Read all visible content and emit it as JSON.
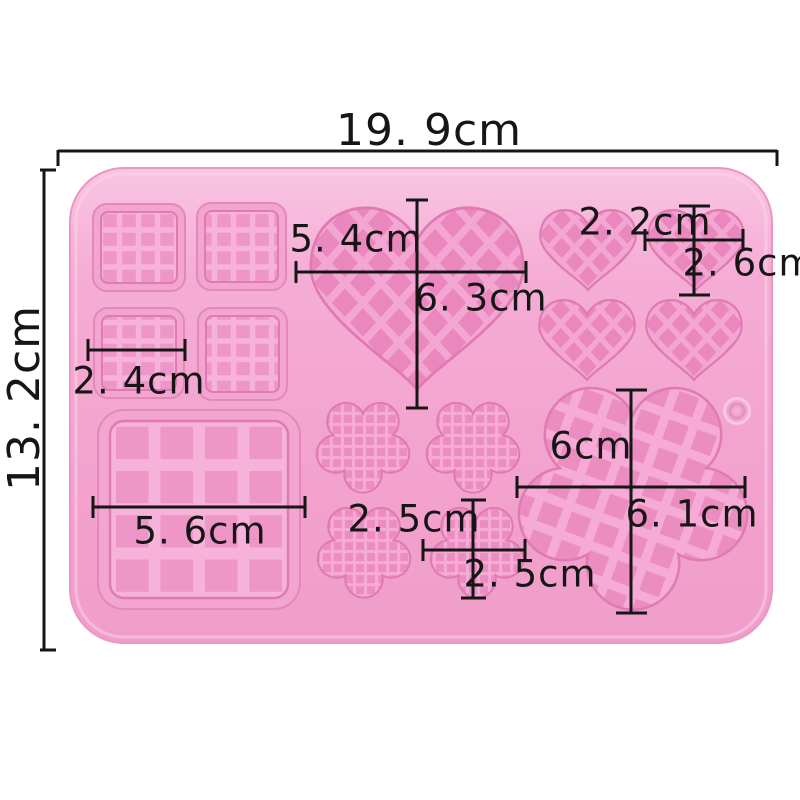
{
  "image_type": "product dimension photo",
  "subject": "Pink silicone waffle mold (hearts, flowers, squares) with measurement annotations",
  "background_color": "#ffffff",
  "mold": {
    "body_color": "#f3a6d0",
    "cavity_floor_color": "#eb8bc0",
    "lattice_color": "#f6b0d8",
    "cavities": {
      "small_squares": 4,
      "large_square": 1,
      "large_heart": 1,
      "small_hearts": 4,
      "small_flowers": 4,
      "large_flower": 1
    }
  },
  "annotations": {
    "color": "#161616",
    "overall_width": "19. 9cm",
    "overall_height": "13. 2cm",
    "large_heart_width": "5. 4cm",
    "large_heart_height": "6. 3cm",
    "small_heart_width": "2. 2cm",
    "small_heart_height": "2. 6cm",
    "small_square_width": "2. 4cm",
    "large_square_width": "5. 6cm",
    "small_flower_height": "2. 5cm",
    "small_flower_width": "2. 5cm",
    "large_flower_height": "6cm",
    "large_flower_width": "6. 1cm"
  }
}
